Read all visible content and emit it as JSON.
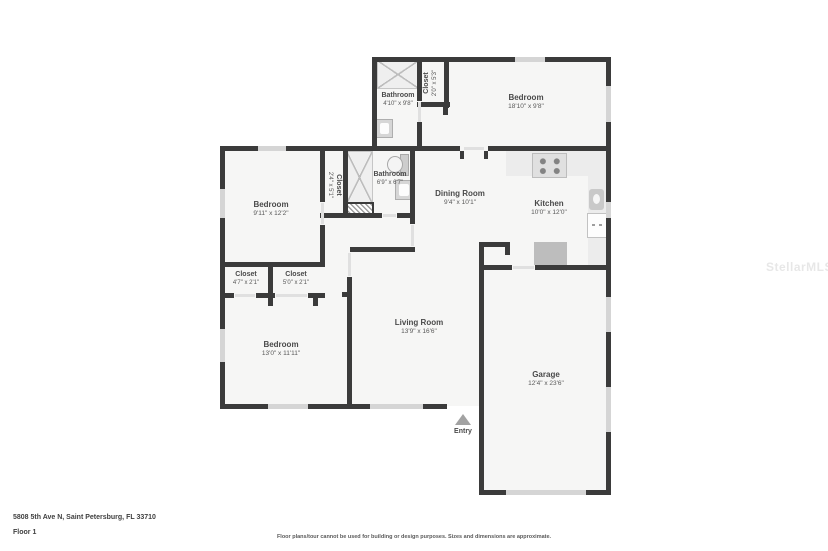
{
  "title": "Floor plan - 5808 5th Ave N",
  "colors": {
    "wall": "#3b3b3b",
    "floor": "#f6f6f5",
    "window": "#d5d5d5",
    "appliance": "#bdbdbd",
    "text": "#4a4a4a"
  },
  "rooms": {
    "bathroom_top": {
      "name": "Bathroom",
      "dims": "4'10\" x 9'8\""
    },
    "closet_top": {
      "name": "Closet",
      "dims": "2'0\" x 5'3\""
    },
    "bedroom_top": {
      "name": "Bedroom",
      "dims": "18'10\" x 9'8\""
    },
    "bedroom_mid": {
      "name": "Bedroom",
      "dims": "9'11\" x 12'2\""
    },
    "closet_mid": {
      "name": "Closet",
      "dims": "2'4\" x 5'1\""
    },
    "bathroom_mid": {
      "name": "Bathroom",
      "dims": "6'9\" x 6'7\""
    },
    "dining": {
      "name": "Dining Room",
      "dims": "9'4\" x 10'1\""
    },
    "kitchen": {
      "name": "Kitchen",
      "dims": "10'0\" x 12'0\""
    },
    "closet_a": {
      "name": "Closet",
      "dims": "4'7\" x 2'1\""
    },
    "closet_b": {
      "name": "Closet",
      "dims": "5'0\" x 2'1\""
    },
    "bedroom_bottom": {
      "name": "Bedroom",
      "dims": "13'0\" x 11'11\""
    },
    "living": {
      "name": "Living Room",
      "dims": "13'9\" x 16'6\""
    },
    "garage": {
      "name": "Garage",
      "dims": "12'4\" x 23'6\""
    },
    "entry": {
      "label": "Entry"
    }
  },
  "icons": {
    "entry_arrow": "triangle-up",
    "shower": "x-pattern-square",
    "toilet": "bowl-and-tank",
    "sink": "square-basin",
    "stove": "four-burners",
    "utility": "diagonal-hatch"
  },
  "footer": {
    "address": "5808 5th Ave N, Saint Petersburg, FL 33710",
    "floor": "Floor 1",
    "disclaimer": "Floor plans/tour cannot be used for building or design purposes. Sizes and dimensions are approximate."
  },
  "watermark": "StellarMLS"
}
